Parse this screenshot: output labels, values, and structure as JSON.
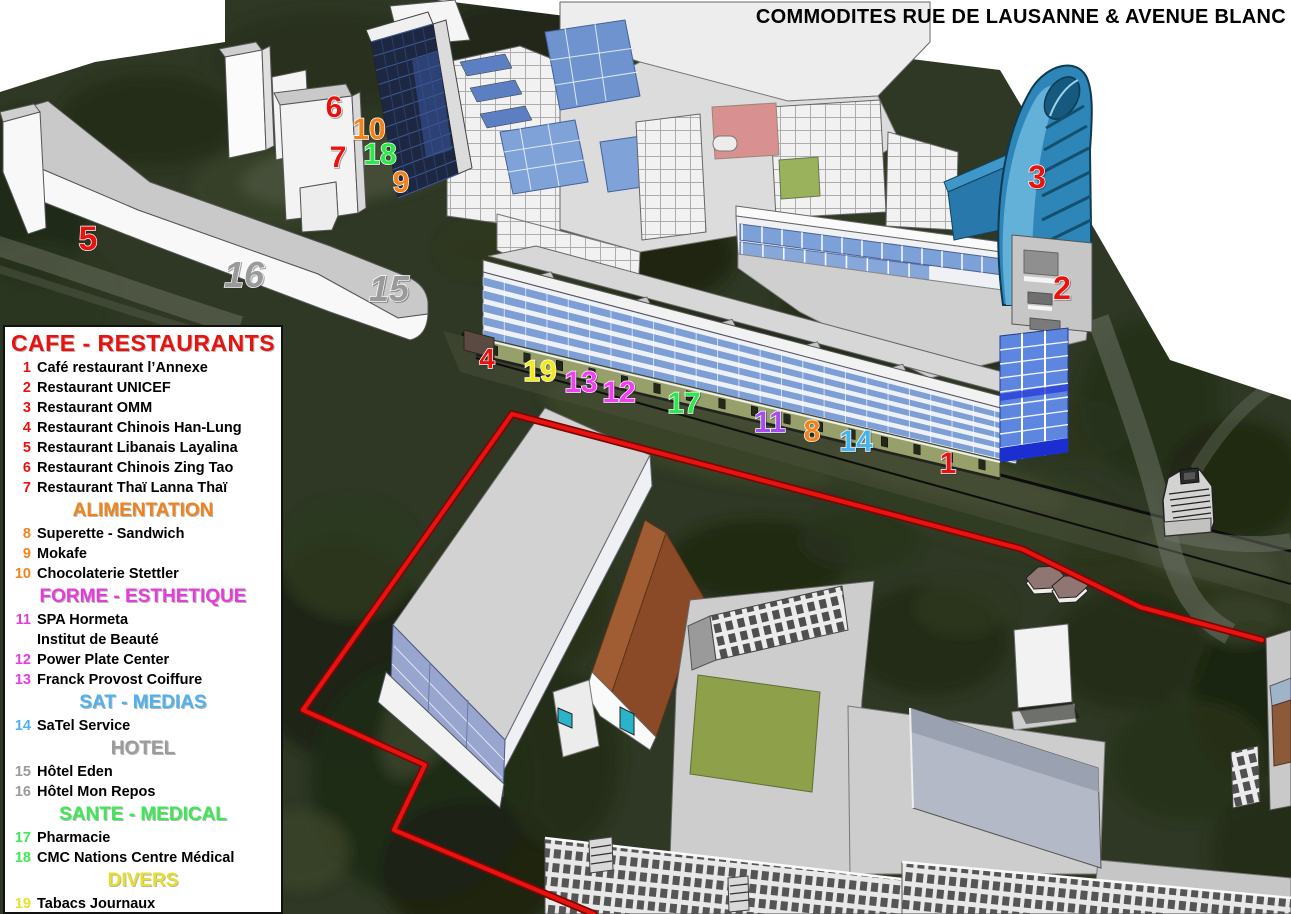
{
  "title": "COMMODITES RUE DE LAUSANNE & AVENUE BLANC",
  "colors": {
    "route_red": "#e8120e",
    "tower_blue": "#2d85b8",
    "legend_red": "#e8120e",
    "legend_orange": "#f0831c",
    "legend_magenta": "#e53cdb",
    "legend_blue": "#4fb2ee",
    "legend_gray": "#9b9b9b",
    "legend_green": "#3ee854",
    "legend_yellow": "#e8df2a"
  },
  "legend": {
    "sections": [
      {
        "heading": "CAFE - RESTAURANTS",
        "color": "#e8120e",
        "items": [
          {
            "num": "1",
            "label": "Café restaurant l’Annexe"
          },
          {
            "num": "2",
            "label": "Restaurant UNICEF"
          },
          {
            "num": "3",
            "label": "Restaurant OMM"
          },
          {
            "num": "4",
            "label": "Restaurant Chinois Han-Lung"
          },
          {
            "num": "5",
            "label": "Restaurant Libanais Layalina"
          },
          {
            "num": "6",
            "label": "Restaurant Chinois Zing Tao"
          },
          {
            "num": "7",
            "label": "Restaurant Thaï Lanna Thaï"
          }
        ]
      },
      {
        "heading": "ALIMENTATION",
        "color": "#f0831c",
        "items": [
          {
            "num": "8",
            "label": "Superette - Sandwich"
          },
          {
            "num": "9",
            "label": "Mokafe"
          },
          {
            "num": "10",
            "label": "Chocolaterie Stettler"
          }
        ]
      },
      {
        "heading": "FORME - ESTHETIQUE",
        "color": "#e53cdb",
        "items": [
          {
            "num": "11",
            "label": "SPA Hormeta",
            "sublabel": "Institut de Beauté"
          },
          {
            "num": "12",
            "label": "Power Plate Center"
          },
          {
            "num": "13",
            "label": "Franck Provost Coiffure"
          }
        ]
      },
      {
        "heading": "SAT - MEDIAS",
        "color": "#4fb2ee",
        "items": [
          {
            "num": "14",
            "label": "SaTel Service"
          }
        ]
      },
      {
        "heading": "HOTEL",
        "color": "#9b9b9b",
        "items": [
          {
            "num": "15",
            "label": "Hôtel Eden"
          },
          {
            "num": "16",
            "label": "Hôtel Mon Repos"
          }
        ]
      },
      {
        "heading": "SANTE - MEDICAL",
        "color": "#3ee854",
        "items": [
          {
            "num": "17",
            "label": "Pharmacie"
          },
          {
            "num": "18",
            "label": "CMC Nations Centre Médical"
          }
        ]
      },
      {
        "heading": "DIVERS",
        "color": "#e8df2a",
        "items": [
          {
            "num": "19",
            "label": "Tabacs Journaux"
          }
        ]
      }
    ]
  },
  "map_markers": [
    {
      "n": "6",
      "x": 334,
      "y": 117,
      "c": "#e8120e",
      "s": 30
    },
    {
      "n": "10",
      "x": 369,
      "y": 139,
      "c": "#f0831c",
      "s": 30
    },
    {
      "n": "7",
      "x": 338,
      "y": 167,
      "c": "#e8120e",
      "s": 30
    },
    {
      "n": "18",
      "x": 380,
      "y": 164,
      "c": "#2ce84a",
      "s": 30
    },
    {
      "n": "9",
      "x": 401,
      "y": 192,
      "c": "#f0831c",
      "s": 30
    },
    {
      "n": "5",
      "x": 88,
      "y": 250,
      "c": "#e8120e",
      "s": 34
    },
    {
      "n": "16",
      "x": 244,
      "y": 287,
      "c": "#9a9a9a",
      "s": 36,
      "i": 1
    },
    {
      "n": "15",
      "x": 389,
      "y": 301,
      "c": "#9a9a9a",
      "s": 36,
      "i": 1
    },
    {
      "n": "3",
      "x": 1037,
      "y": 188,
      "c": "#e8120e",
      "s": 32
    },
    {
      "n": "2",
      "x": 1062,
      "y": 299,
      "c": "#e8120e",
      "s": 32
    },
    {
      "n": "4",
      "x": 487,
      "y": 368,
      "c": "#e8120e",
      "s": 28
    },
    {
      "n": "19",
      "x": 540,
      "y": 381,
      "c": "#f2ea1a",
      "s": 30
    },
    {
      "n": "13",
      "x": 581,
      "y": 392,
      "c": "#f23ff2",
      "s": 30
    },
    {
      "n": "12",
      "x": 619,
      "y": 402,
      "c": "#f23ff2",
      "s": 30
    },
    {
      "n": "17",
      "x": 684,
      "y": 413,
      "c": "#2ce84a",
      "s": 30
    },
    {
      "n": "11",
      "x": 770,
      "y": 432,
      "c": "#a64df2",
      "s": 30
    },
    {
      "n": "8",
      "x": 812,
      "y": 441,
      "c": "#f0831c",
      "s": 30
    },
    {
      "n": "14",
      "x": 856,
      "y": 451,
      "c": "#45b4ec",
      "s": 30
    },
    {
      "n": "1",
      "x": 948,
      "y": 473,
      "c": "#e8120e",
      "s": 30
    }
  ]
}
